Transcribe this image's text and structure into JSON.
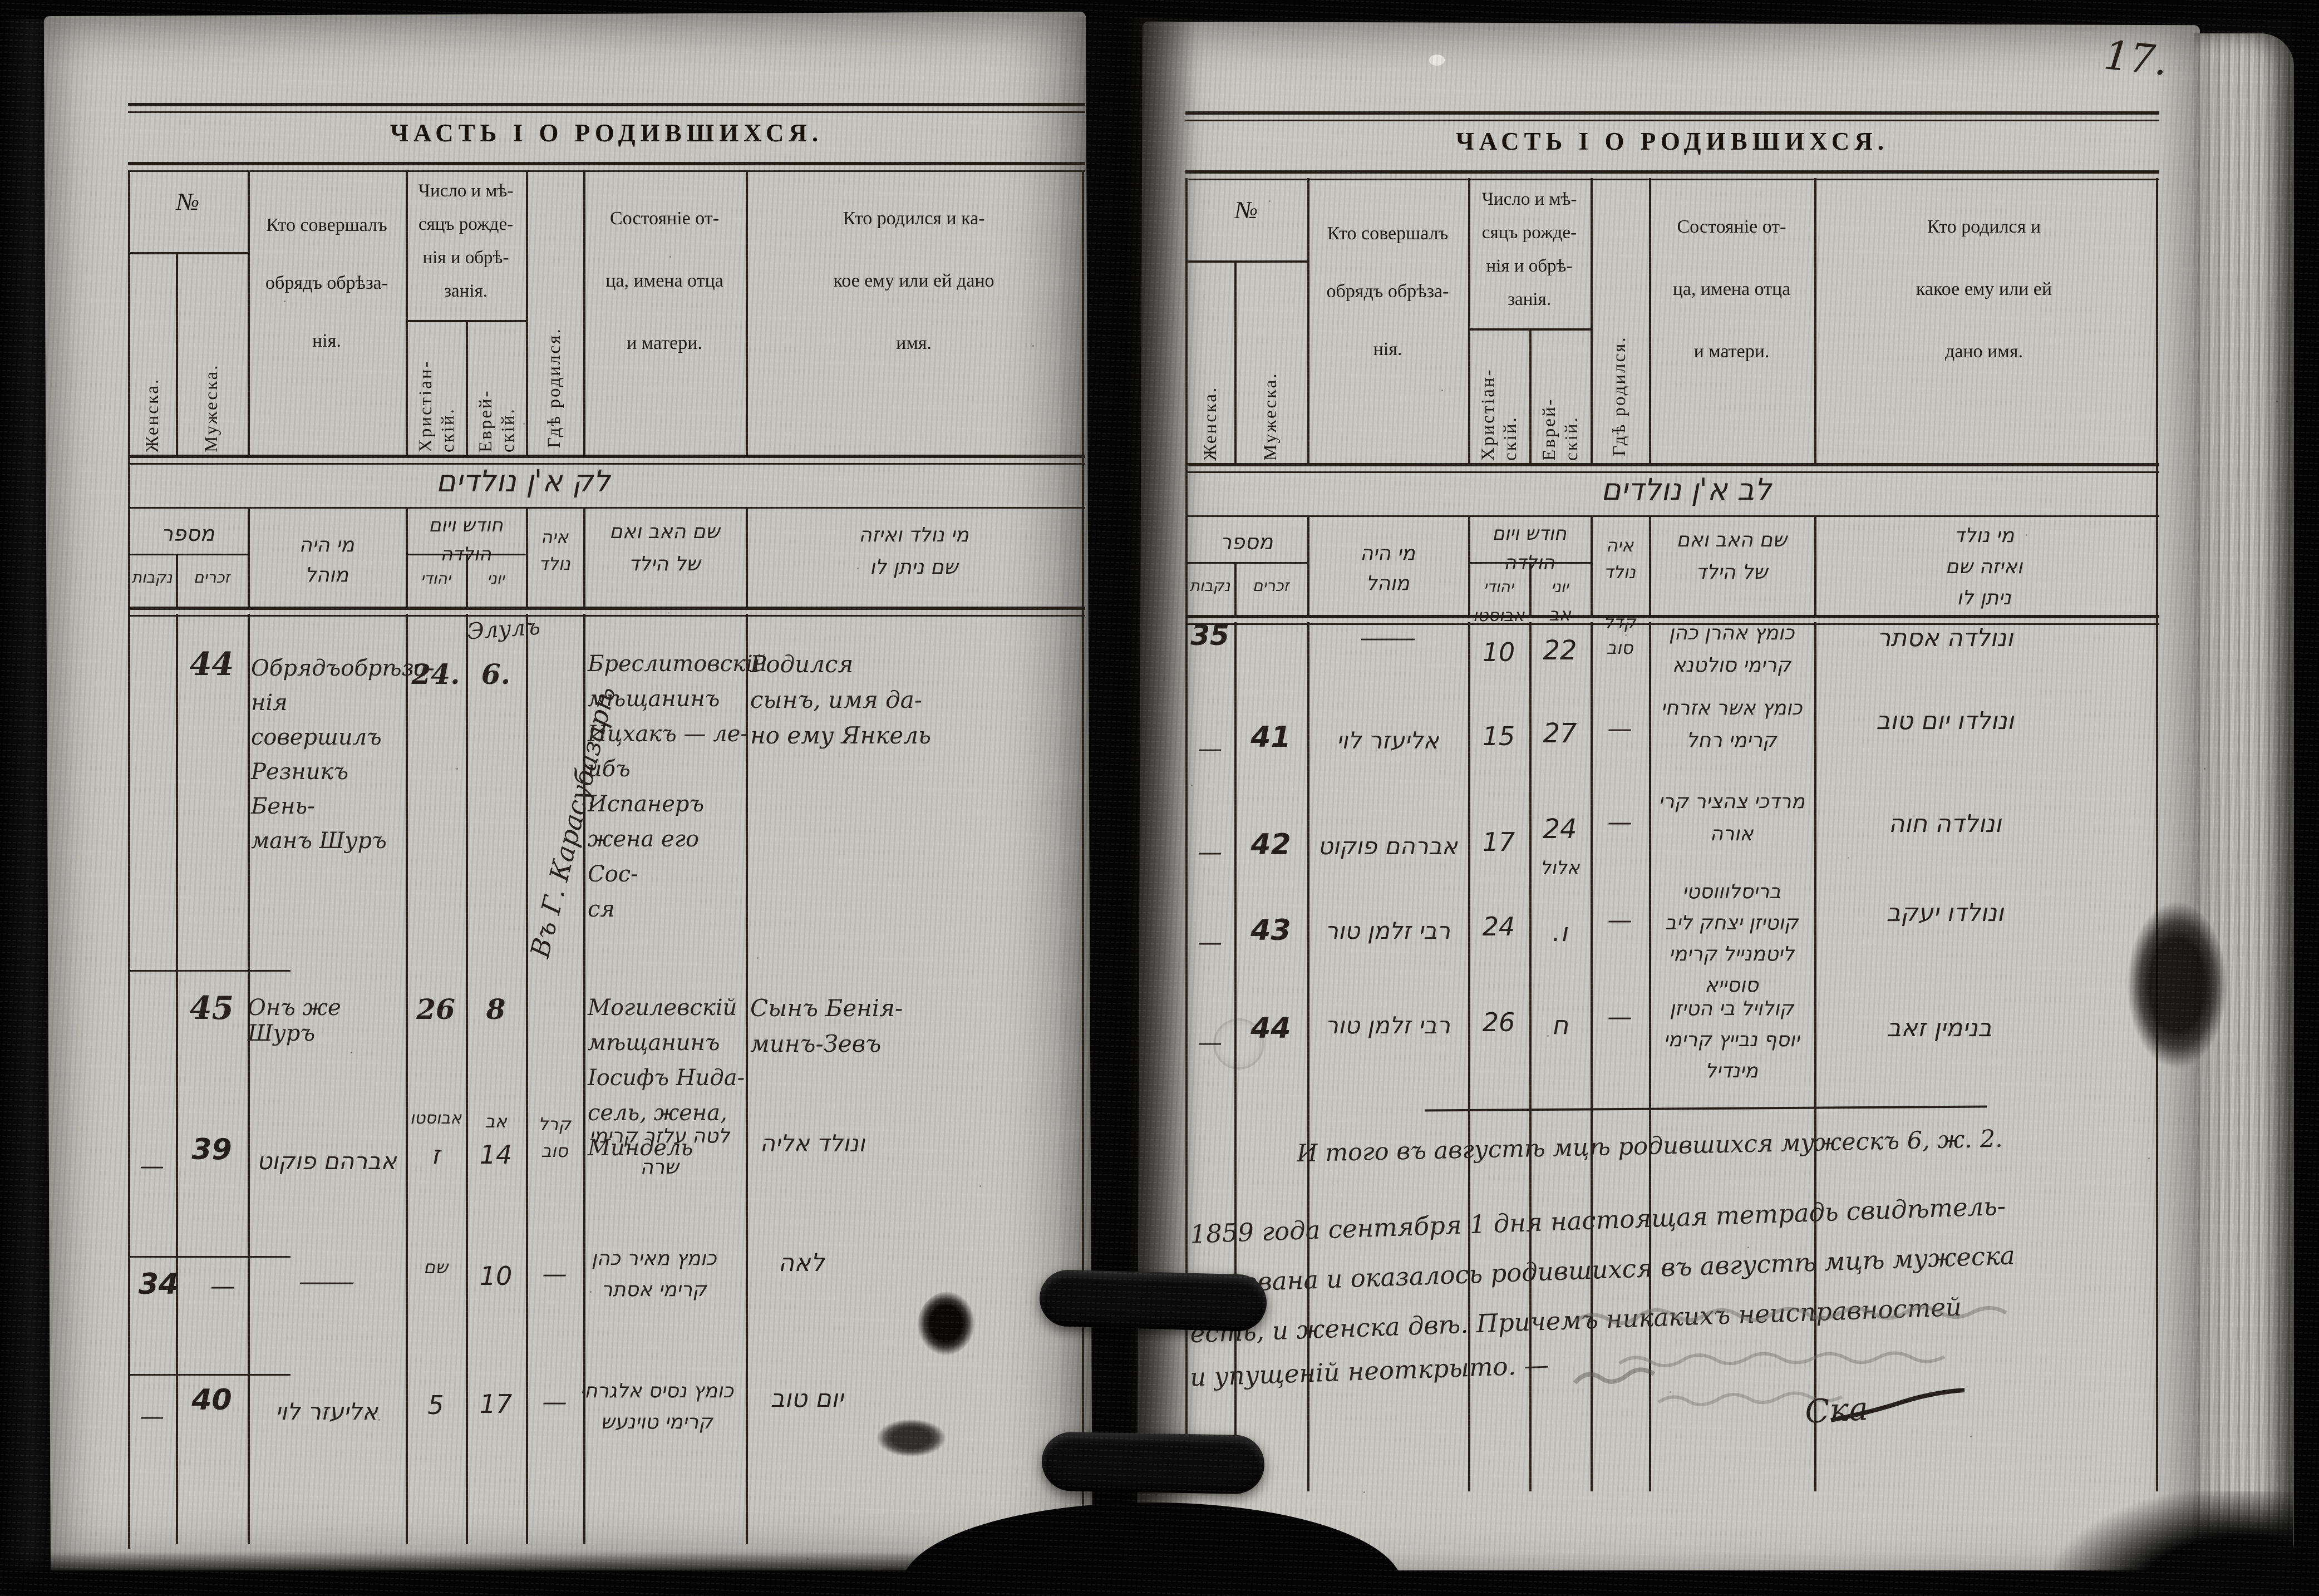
{
  "document": {
    "page_number": "17."
  },
  "ru_columns": {
    "num": "№",
    "female": "Женска.",
    "male": "Мужеска.",
    "mohel": "Кто совершалъ\nобрядъ обрѣза-\nнія.",
    "date": "Число и мѣ-\nсяцъ рожде-\nнія и обрѣ-\nзанія.",
    "christian": "Христіан-\nскій.",
    "jewish": "Еврей-\nскій.",
    "where": "Гдѣ родился.",
    "father": "Состояніе от-\nца, имена отца\nи матери.",
    "name_left": "Кто родился и ка-\nкое ему или ей дано\nимя.",
    "name_right": "Кто родился и\nкакое ему или ей\nдано имя."
  },
  "he_columns": {
    "title_left": "לק א'ן נולדים",
    "title_right": "לב א'ן נולדים",
    "num": "מספר",
    "males": "זכרים",
    "females": "נקבות",
    "mohel": "מי היה\nמוהל",
    "date": "חודש ויום\nהולדה",
    "jewish": "יהודי",
    "greek": "יוני",
    "where": "איה\nנולד",
    "father": "שם האב ואם\nשל הילד",
    "name_left": "מי נולד ואיזה\nשם ניתן לו",
    "name_right": "מי נולד\nואיזה שם\nניתן לו"
  },
  "left_page": {
    "title": "ЧАСТЬ I О РОДИВШИХСЯ.",
    "rows": {
      "r44": {
        "num": "44",
        "mohel": "Обрядъобрѣза-\nнія совершилъ\nРезникъ Бень-\nманъ Шуръ",
        "chr": "24.",
        "evr_month": "Элулъ",
        "evr": "6.",
        "where": "Въ Г. Карасубазарѣ",
        "father": "Бреслитовскій\nмѣщанинъ\nИцхакъ — ле-\nибъ Испанеръ\nжена его Сос-\nся",
        "name": "Родился\nсынъ, имя да-\nно ему Янкель"
      },
      "r45": {
        "num": "45",
        "mohel": "Онъ же Шуръ",
        "chr": "26",
        "evr": "8",
        "father": "Могилевскій\nмѣщанинъ\nІосифъ Нида-\nсель, жена,\nМиндель",
        "name": "Сынъ Бенія-\nминъ-Зевъ"
      },
      "hA": {
        "female": "—",
        "num": "39",
        "mohel": "אברהם פוקוט",
        "chr_month": "אבוסטו",
        "chr": "ז",
        "evr_month": "אב",
        "evr": "14",
        "where": "קרל\nסוב",
        "father": "לטה עלזר קרימי\nשרה",
        "name": "ונולד אליה"
      },
      "hB": {
        "female_num": "34",
        "male": "—",
        "mohel": "—",
        "chr_month": "שם",
        "chr": "10",
        "evr": "—",
        "father": "כומץ מאיר כהן\nקרימי אסתר",
        "name": "לאה"
      },
      "hC": {
        "female": "—",
        "num": "40",
        "mohel": "אליעזר לוי",
        "chr": "5",
        "evr": "17",
        "where": "—",
        "father": "כומץ נסיס אלגרחי\nקרימי טוינעש",
        "name": "יום טוב"
      }
    }
  },
  "right_page": {
    "title": "ЧАСТЬ I О РОДИВШИХСЯ.",
    "rows": {
      "h35": {
        "female_num": "35",
        "mohel": "—",
        "chr_month": "אבוסטו",
        "chr": "10",
        "evr_month": "אב",
        "evr": "22",
        "where": "קדל\nסוב",
        "father": "כומץ אהרן כהן\nקרימי סולטנא",
        "name": "ונולדה אסתר"
      },
      "h41": {
        "female": "—",
        "num": "41",
        "mohel": "אליעזר לוי",
        "chr": "15",
        "evr": "27",
        "where": "—",
        "father": "כומץ אשר אזרחי\nקרימי רחל",
        "name": "ונולדו יום טוב"
      },
      "h42": {
        "female": "—",
        "num": "42",
        "mohel": "אברהם פוקוט",
        "chr": "17",
        "evr": "24",
        "evr_month_below": "אלול",
        "where": "—",
        "father": "מרדכי צהציר קרי\nאורה",
        "name": "ונולדה חוה"
      },
      "h43": {
        "female": "—",
        "num": "43",
        "mohel": "רבי זלמן טור",
        "chr": "24",
        "evr": "ו.",
        "where": "—",
        "father": "בריסלוווסטי\nקוטיזן יצחק ליב\nליטמנייל קרימי\nסוסייא",
        "name": "ונולדו יעקב"
      },
      "h44": {
        "female": "—",
        "num": "44",
        "mohel": "רבי זלמן טור",
        "chr": "26",
        "evr": "ח",
        "where": "—",
        "father": "קולויל בי הטיזן\nיוסף נבייץ קרימי\nמינדיל",
        "name": "בנימין זאב"
      }
    },
    "summary": "И того въ августѣ мцѣ родившихся мужескъ 6, ж. 2.",
    "certification": {
      "l1": "1859 года  сентября 1 дня настоящая тетрадь свидѣтель-",
      "l2": "ствована и оказалось родившихся въ августѣ мцѣ мужеска",
      "l3": "есть, и женска двѣ.  Причемъ никакихъ неисправностей",
      "l4": "и упущеній неоткрыто. —"
    },
    "signature": "Ска",
    "pencil_annotation": {
      "legible": false,
      "lines": 3
    }
  }
}
